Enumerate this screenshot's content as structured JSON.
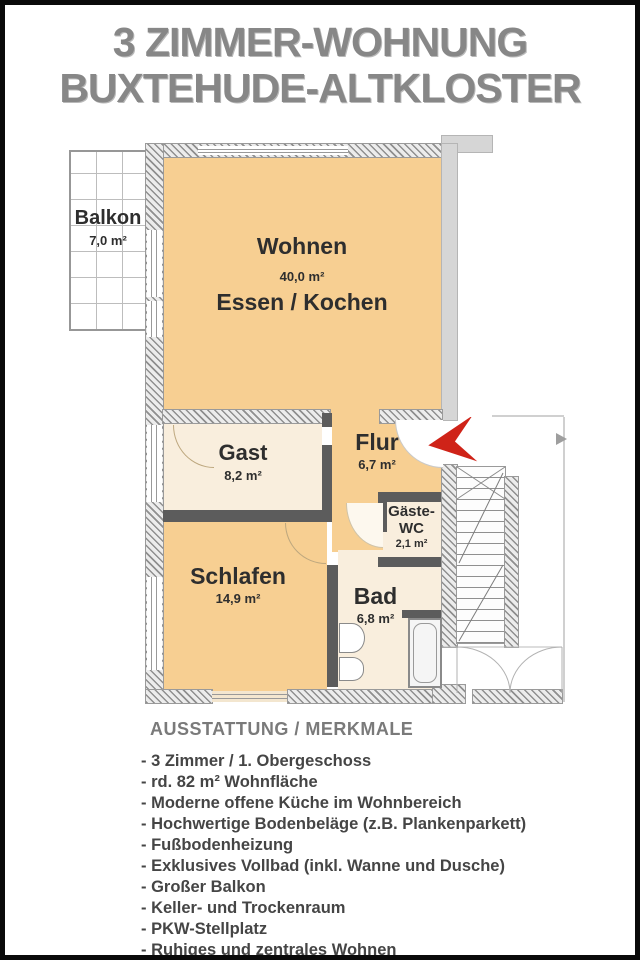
{
  "title": {
    "line1": "3 ZIMMER-WOHNUNG",
    "line2": "BUXTEHUDE-ALTKLOSTER"
  },
  "floorplan": {
    "rooms": {
      "balkon": {
        "name": "Balkon",
        "area": "7,0 m²"
      },
      "wohnen": {
        "name": "Wohnen",
        "area": "40,0 m²",
        "subtitle": "Essen / Kochen"
      },
      "gast": {
        "name": "Gast",
        "area": "8,2 m²"
      },
      "flur": {
        "name": "Flur",
        "area": "6,7 m²"
      },
      "gaeste_wc": {
        "name_line1": "Gäste-",
        "name_line2": "WC",
        "area": "2,1 m²"
      },
      "schlafen": {
        "name": "Schlafen",
        "area": "14,9 m²"
      },
      "bad": {
        "name": "Bad",
        "area": "6,8 m²"
      }
    },
    "colors": {
      "room_orange": "#f7cf92",
      "room_cream": "#f9eedd",
      "wall_dark": "#5c5c5c",
      "entrance_arrow": "#cf2318"
    }
  },
  "features": {
    "heading": "AUSSTATTUNG / MERKMALE",
    "items": [
      "- 3 Zimmer / 1. Obergeschoss",
      "- rd. 82 m² Wohnfläche",
      "- Moderne offene Küche im Wohnbereich",
      "- Hochwertige Bodenbeläge (z.B. Plankenparkett)",
      "- Fußbodenheizung",
      "- Exklusives Vollbad (inkl. Wanne und Dusche)",
      "- Großer Balkon",
      "- Keller- und Trockenraum",
      "- PKW-Stellplatz",
      "- Ruhiges und zentrales Wohnen"
    ]
  }
}
